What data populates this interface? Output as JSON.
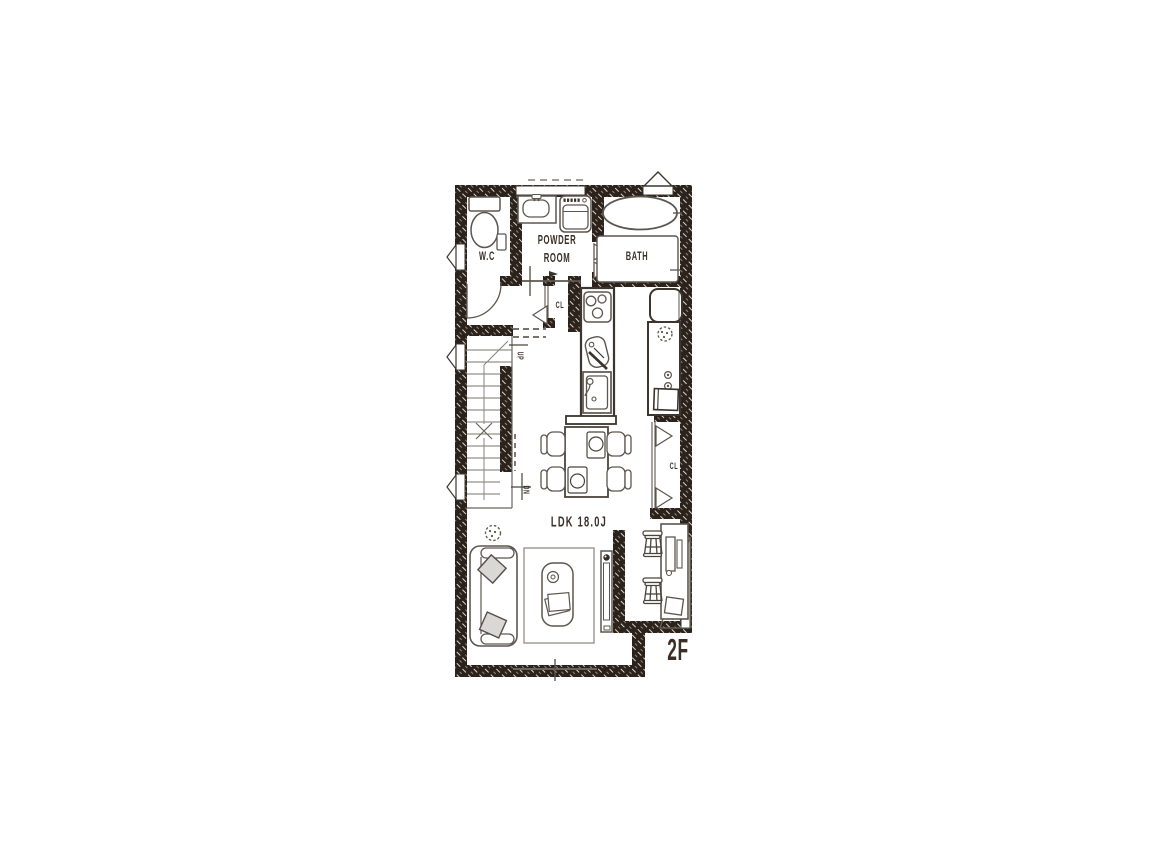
{
  "plan": {
    "floor_label": "2F",
    "area_label": "LDK 18.0J",
    "colors": {
      "paper": "#ffffff",
      "wall": "#2b221b",
      "outline": "#3c352d",
      "furniture_line": "#5d564e",
      "light_line": "#8a847c",
      "cushion_fill": "#d9d8d5"
    },
    "rooms": {
      "wc": {
        "label": "W.C"
      },
      "powder_room": {
        "label": [
          "POWDER",
          "ROOM"
        ]
      },
      "bath": {
        "label": "BATH"
      },
      "hall_closet": {
        "label": "CL"
      },
      "ldk_closet": {
        "label": "CL"
      },
      "stairs": {
        "up": "UP",
        "down": "DN"
      }
    },
    "fixtures": [
      "toilet",
      "vanity-sink",
      "washing-machine",
      "bathtub",
      "folding-door",
      "swing-door",
      "sliding-door",
      "gas-stove",
      "cutting-board",
      "kitchen-sink",
      "refrigerator",
      "kitchen-counter",
      "dining-table",
      "dining-chair",
      "sofa",
      "cushion",
      "plant",
      "rug",
      "low-table",
      "tv",
      "study-desk",
      "stool",
      "laptop",
      "window",
      "stairs"
    ]
  }
}
